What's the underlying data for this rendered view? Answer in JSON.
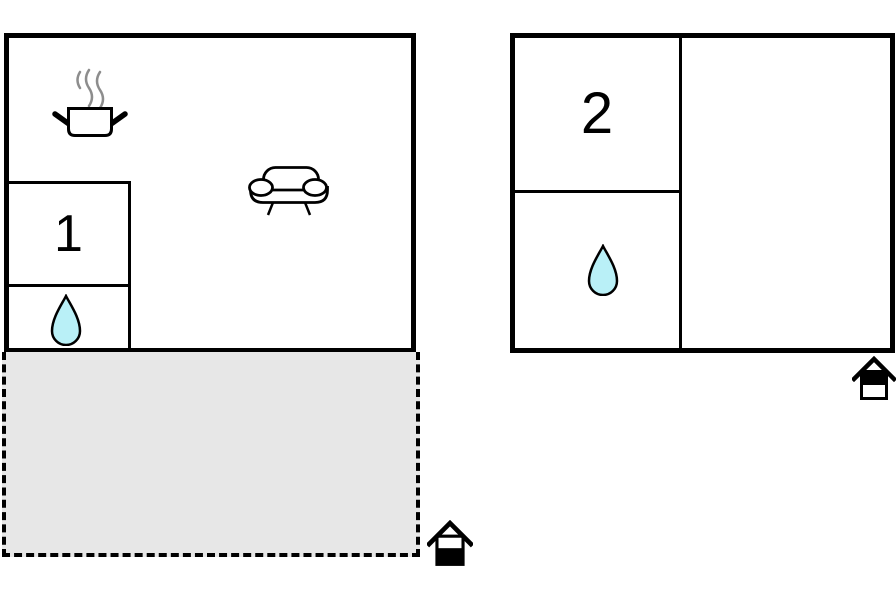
{
  "page": {
    "background": "#ffffff"
  },
  "colors": {
    "wall": "#000000",
    "water_drop_fill": "#b9f0f7",
    "terrace_fill": "#e7e7e7",
    "steam_gray": "#8d8d8d"
  },
  "buildings": [
    {
      "name": "main-house",
      "rooms": [
        {
          "label": "1",
          "type": "bedroom"
        },
        {
          "type": "bathroom",
          "icon": "water-drop-icon"
        },
        {
          "type": "kitchen-living-area",
          "icons": [
            "cooking-pot-icon",
            "sofa-icon"
          ]
        }
      ],
      "terrace": {
        "type": "terrace-patio",
        "outline": "dashed"
      },
      "entrance_marker": "house-entrance-icon"
    },
    {
      "name": "annex",
      "rooms": [
        {
          "label": "2",
          "type": "bedroom"
        },
        {
          "type": "bathroom",
          "icon": "water-drop-icon"
        },
        {
          "type": "undesignated-room"
        }
      ],
      "entrance_marker": "house-entrance-icon"
    }
  ]
}
